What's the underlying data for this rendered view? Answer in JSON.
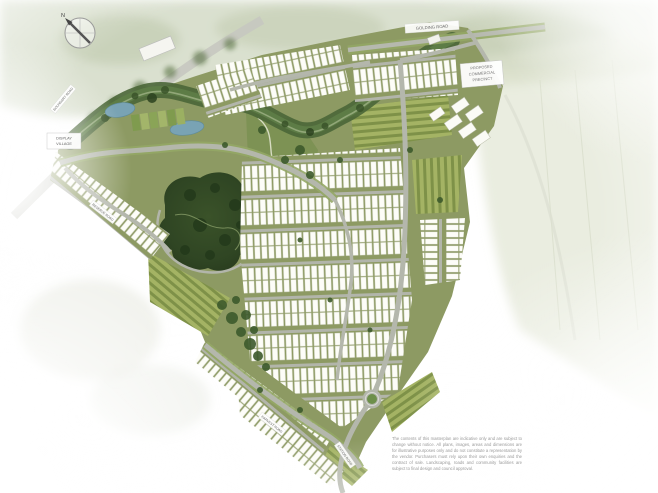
{
  "compass": {
    "north_label": "N"
  },
  "labels": {
    "top_road": "GOLDING ROAD",
    "west_road": "BOUNDARY ROAD",
    "mid_west_road": "RESERVE ROAD",
    "south_road_1": "HARVEST ROAD",
    "south_road_2": "STATION ROAD",
    "display_village": {
      "line1": "DISPLAY",
      "line2": "VILLAGE"
    },
    "commercial_precinct": {
      "line1": "PROPOSED",
      "line2": "COMMERCIAL",
      "line3": "PRECINCT"
    }
  },
  "disclaimer": {
    "text": "The contents of this masterplan are indicative only and are subject to change without notice. All plans, images, areas and dimensions are for illustrative purposes only and do not constitute a representation by the vendor. Purchasers must rely upon their own enquiries and the contract of sale. Landscaping, roads and community facilities are subject to final design and council approval."
  },
  "colors": {
    "site_green": "#8d9a63",
    "open_space_green": "#7d9254",
    "forest_green": "#2f4523",
    "creek_green": "#4a6637",
    "water_blue": "#79a3b4",
    "road_gray": "#b4b7ac",
    "lot_white": "#fdfdf8",
    "stripe_light": "#a4b364",
    "stripe_dark": "#7e9148",
    "roundabout_green": "#6d8f4a",
    "surround_green": "#bcc6a8",
    "label_text": "#666666"
  }
}
